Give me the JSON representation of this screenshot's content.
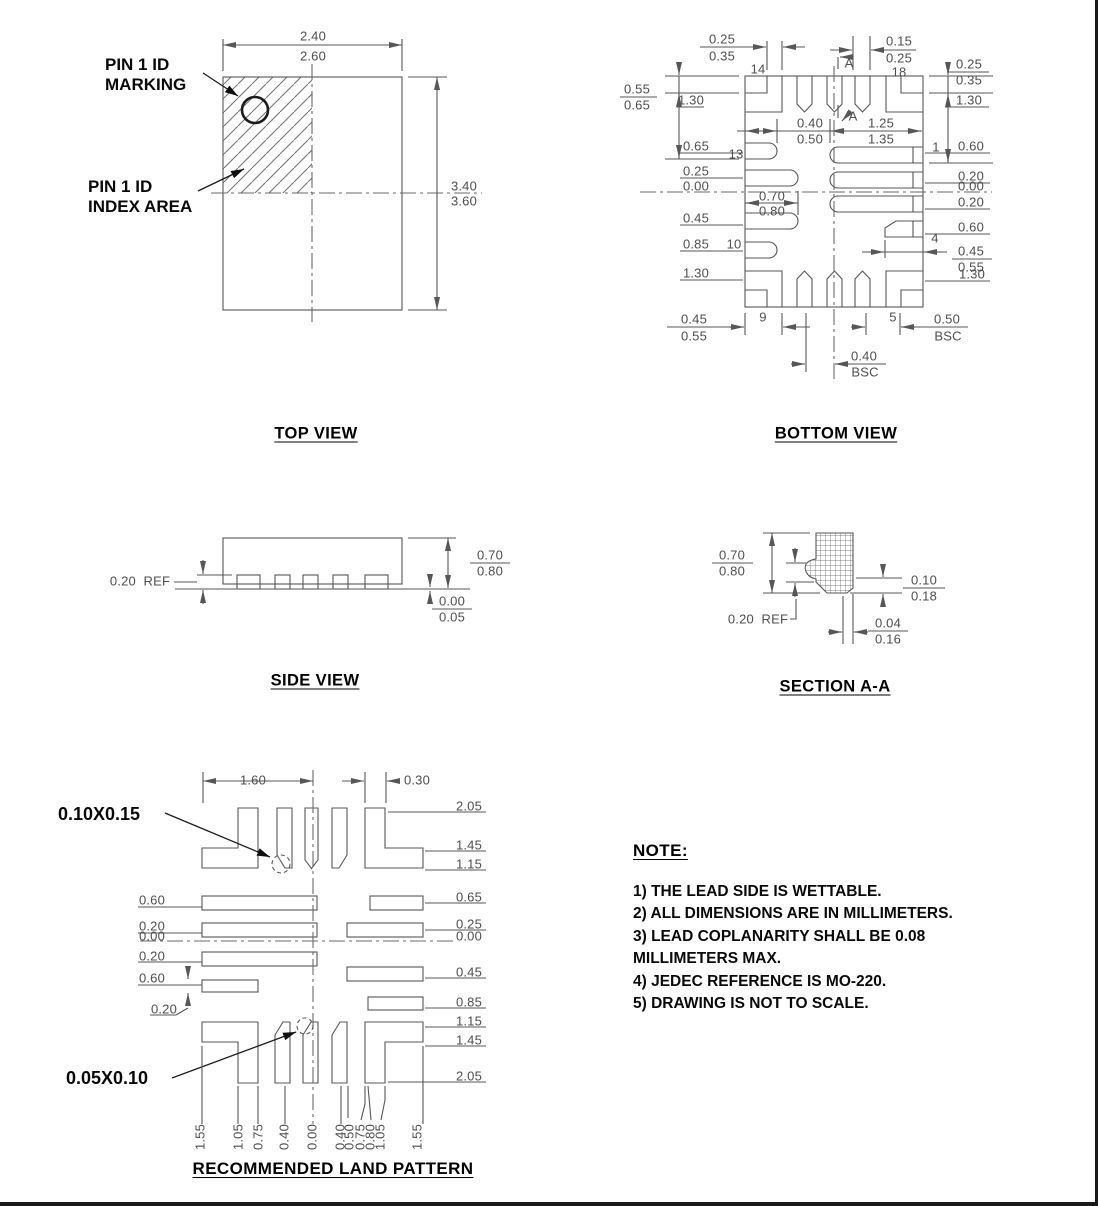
{
  "document": {
    "type": "package-outline-drawing"
  },
  "colors": {
    "line": "#575757",
    "centerline": "#6a6a6a",
    "dim_text": "#4f4f4f",
    "bold_text": "#0a0a0a",
    "border": "#1a1a1a",
    "background": "#ffffff"
  },
  "annotations": {
    "pin1_marking_l1": "PIN 1 ID",
    "pin1_marking_l2": "MARKING",
    "pin1_index_l1": "PIN 1 ID",
    "pin1_index_l2": "INDEX AREA",
    "land_chamfer_top": "0.10X0.15",
    "land_chamfer_bottom": "0.05X0.10"
  },
  "note": {
    "heading": "NOTE:",
    "lines": [
      "1) THE LEAD SIDE IS WETTABLE.",
      "2) ALL DIMENSIONS ARE IN MILLIMETERS.",
      "3) LEAD COPLANARITY SHALL BE 0.08",
      "MILLIMETERS MAX.",
      "4) JEDEC REFERENCE IS MO-220.",
      "5) DRAWING IS NOT TO SCALE."
    ]
  },
  "views": {
    "top": {
      "title": "TOP VIEW",
      "labels": [
        {
          "t": "2.40",
          "x": 313,
          "y": 36
        },
        {
          "t": "2.60",
          "x": 313,
          "y": 56
        },
        {
          "t": "3.40",
          "x": 464,
          "y": 186
        },
        {
          "t": "3.60",
          "x": 464,
          "y": 201
        }
      ]
    },
    "bottom": {
      "title": "BOTTOM VIEW",
      "labels": [
        {
          "t": "0.25",
          "x": 722,
          "y": 39
        },
        {
          "t": "0.35",
          "x": 722,
          "y": 56
        },
        {
          "t": "0.15",
          "x": 899,
          "y": 41
        },
        {
          "t": "0.25",
          "x": 899,
          "y": 58
        },
        {
          "t": "14",
          "x": 758,
          "y": 69
        },
        {
          "t": "18",
          "x": 899,
          "y": 72
        },
        {
          "t": "A",
          "x": 849,
          "y": 63
        },
        {
          "t": "A",
          "x": 853,
          "y": 116
        },
        {
          "t": "0.25",
          "x": 969,
          "y": 64
        },
        {
          "t": "0.35",
          "x": 969,
          "y": 80
        },
        {
          "t": "1.30",
          "x": 969,
          "y": 100
        },
        {
          "t": "0.55",
          "x": 637,
          "y": 89
        },
        {
          "t": "0.65",
          "x": 637,
          "y": 105
        },
        {
          "t": "1.30",
          "x": 691,
          "y": 100
        },
        {
          "t": "0.40",
          "x": 810,
          "y": 123
        },
        {
          "t": "0.50",
          "x": 810,
          "y": 139
        },
        {
          "t": "1.25",
          "x": 881,
          "y": 123
        },
        {
          "t": "1.35",
          "x": 881,
          "y": 139
        },
        {
          "t": "0.65",
          "x": 696,
          "y": 146
        },
        {
          "t": "13",
          "x": 736,
          "y": 154
        },
        {
          "t": "0.25",
          "x": 696,
          "y": 171
        },
        {
          "t": "0.00",
          "x": 696,
          "y": 186
        },
        {
          "t": "0.70",
          "x": 772,
          "y": 196
        },
        {
          "t": "0.80",
          "x": 772,
          "y": 211
        },
        {
          "t": "0.45",
          "x": 696,
          "y": 218
        },
        {
          "t": "0.85",
          "x": 696,
          "y": 244
        },
        {
          "t": "10",
          "x": 734,
          "y": 244
        },
        {
          "t": "1.30",
          "x": 696,
          "y": 273
        },
        {
          "t": "1",
          "x": 936,
          "y": 147
        },
        {
          "t": "0.60",
          "x": 971,
          "y": 146
        },
        {
          "t": "0.20",
          "x": 971,
          "y": 176
        },
        {
          "t": "0.00",
          "x": 971,
          "y": 186
        },
        {
          "t": "0.20",
          "x": 971,
          "y": 202
        },
        {
          "t": "0.60",
          "x": 971,
          "y": 227
        },
        {
          "t": "4",
          "x": 935,
          "y": 238
        },
        {
          "t": "0.45",
          "x": 971,
          "y": 251
        },
        {
          "t": "0.55",
          "x": 971,
          "y": 267
        },
        {
          "t": "1.30",
          "x": 972,
          "y": 274
        },
        {
          "t": "9",
          "x": 763,
          "y": 317
        },
        {
          "t": "5",
          "x": 893,
          "y": 317
        },
        {
          "t": "0.45",
          "x": 694,
          "y": 319
        },
        {
          "t": "0.55",
          "x": 694,
          "y": 336
        },
        {
          "t": "0.50",
          "x": 947,
          "y": 319
        },
        {
          "t": "BSC",
          "x": 948,
          "y": 336
        },
        {
          "t": "0.40",
          "x": 864,
          "y": 356
        },
        {
          "t": "BSC",
          "x": 865,
          "y": 372
        }
      ]
    },
    "side": {
      "title": "SIDE VIEW",
      "labels": [
        {
          "t": "0.20  REF",
          "x": 140,
          "y": 581
        },
        {
          "t": "0.70",
          "x": 490,
          "y": 555
        },
        {
          "t": "0.80",
          "x": 490,
          "y": 571
        },
        {
          "t": "0.00",
          "x": 452,
          "y": 601
        },
        {
          "t": "0.05",
          "x": 452,
          "y": 617
        }
      ]
    },
    "section": {
      "title": "SECTION A-A",
      "labels": [
        {
          "t": "0.70",
          "x": 732,
          "y": 555
        },
        {
          "t": "0.80",
          "x": 732,
          "y": 571
        },
        {
          "t": "0.20  REF",
          "x": 758,
          "y": 619
        },
        {
          "t": "0.10",
          "x": 924,
          "y": 580
        },
        {
          "t": "0.18",
          "x": 924,
          "y": 596
        },
        {
          "t": "0.04",
          "x": 888,
          "y": 623
        },
        {
          "t": "0.16",
          "x": 888,
          "y": 639
        }
      ]
    },
    "land": {
      "title": "RECOMMENDED LAND PATTERN",
      "labels": [
        {
          "t": "1.60",
          "x": 253,
          "y": 780
        },
        {
          "t": "0.30",
          "x": 417,
          "y": 780
        },
        {
          "t": "0.60",
          "x": 152,
          "y": 900
        },
        {
          "t": "0.20",
          "x": 152,
          "y": 926
        },
        {
          "t": "0.00",
          "x": 152,
          "y": 936
        },
        {
          "t": "0.20",
          "x": 152,
          "y": 956
        },
        {
          "t": "0.60",
          "x": 152,
          "y": 978
        },
        {
          "t": "0.20",
          "x": 164,
          "y": 1009
        },
        {
          "t": "2.05",
          "x": 469,
          "y": 806
        },
        {
          "t": "1.45",
          "x": 469,
          "y": 845
        },
        {
          "t": "1.15",
          "x": 469,
          "y": 864
        },
        {
          "t": "0.65",
          "x": 469,
          "y": 897
        },
        {
          "t": "0.25",
          "x": 469,
          "y": 924
        },
        {
          "t": "0.00",
          "x": 469,
          "y": 936
        },
        {
          "t": "0.45",
          "x": 469,
          "y": 972
        },
        {
          "t": "0.85",
          "x": 469,
          "y": 1002
        },
        {
          "t": "1.15",
          "x": 469,
          "y": 1021
        },
        {
          "t": "1.45",
          "x": 469,
          "y": 1040
        },
        {
          "t": "2.05",
          "x": 469,
          "y": 1076
        },
        {
          "t": "1.55",
          "x": 200,
          "y": 1137,
          "r": -90
        },
        {
          "t": "1.05",
          "x": 238,
          "y": 1137,
          "r": -90
        },
        {
          "t": "0.75",
          "x": 258,
          "y": 1137,
          "r": -90
        },
        {
          "t": "0.40",
          "x": 284,
          "y": 1137,
          "r": -90
        },
        {
          "t": "0.00",
          "x": 312,
          "y": 1137,
          "r": -90
        },
        {
          "t": "0.40",
          "x": 340,
          "y": 1137,
          "r": -90
        },
        {
          "t": "0.50",
          "x": 349,
          "y": 1137,
          "r": -90
        },
        {
          "t": "0.75",
          "x": 360,
          "y": 1137,
          "r": -90
        },
        {
          "t": "0.80",
          "x": 370,
          "y": 1137,
          "r": -90
        },
        {
          "t": "1.05",
          "x": 380,
          "y": 1137,
          "r": -90
        },
        {
          "t": "1.55",
          "x": 417,
          "y": 1137,
          "r": -90
        }
      ]
    }
  }
}
